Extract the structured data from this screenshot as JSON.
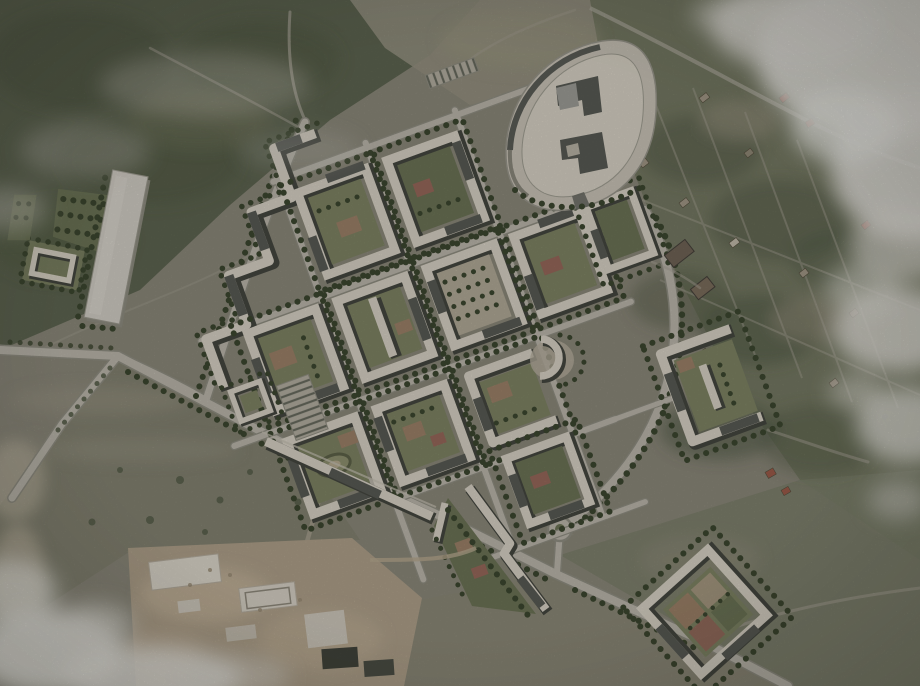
{
  "scene": {
    "description": "Aerial satellite photograph of countryside with a rendered residential master-plan montage: perimeter housing blocks with green courtyards, a curved school campus, access roads, a long warehouse, a village with garden plots to the east, open fields, a construction site to the south and patches of cloud cover",
    "regions": [
      {
        "id": "forest-northwest",
        "label": "Forest"
      },
      {
        "id": "open-fields-west",
        "label": "Open fields"
      },
      {
        "id": "village-east",
        "label": "Village with garden plots and scattered houses"
      },
      {
        "id": "residential-masterplan",
        "label": "Rendered residential district with perimeter blocks"
      },
      {
        "id": "school-campus",
        "label": "Lens-shaped school campus plot"
      },
      {
        "id": "warehouse-site-west",
        "label": "Long warehouse building with landscaped parcels"
      },
      {
        "id": "construction-site-south",
        "label": "Active construction site"
      },
      {
        "id": "clouds",
        "label": "Cloud cover"
      }
    ],
    "counts": {
      "residential_blocks": 14,
      "roundabouts": 1,
      "warehouse_buildings": 1,
      "barn_buildings": 2
    }
  },
  "palette": {
    "terrain": "#8a8779",
    "field": "#93907f",
    "forest": "#5d6450",
    "village": "#747862",
    "road": "#b9b5aa",
    "roadCasing": "#8f8d81",
    "lane": "#a7a295",
    "sidewalk": "#c5bfb2",
    "plaza": "#c8c2b6",
    "roof": "#d6d0c3",
    "roofDark": "#585a54",
    "roofEdge": "#44463f",
    "warehouse": "#d0ccc3",
    "lawn": "#7d8363",
    "lawnDark": "#6b7355",
    "tree": "#3c462f",
    "play": "#9b8067",
    "playRed": "#96675a",
    "dirt": "#ad9f89",
    "slab": "#d9d4c8",
    "stack": "#41443b",
    "cloud": "#dedcd6",
    "barn": "#6f6355",
    "house": "#a09685",
    "houseRed": "#9b5a49"
  }
}
